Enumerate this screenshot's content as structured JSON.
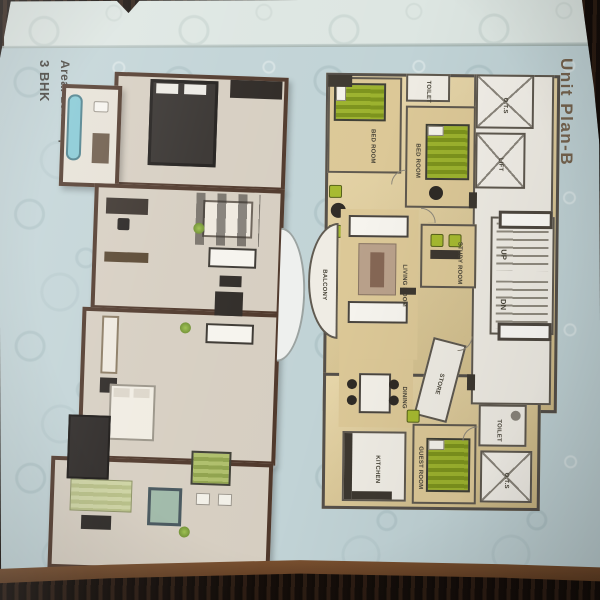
{
  "header": {
    "title": "Unit Plan-B",
    "bhk": "3 BHK",
    "area": "Area: 1946 sq.ft"
  },
  "plan2d": {
    "rooms": {
      "bedroom1": "BED ROOM",
      "toilet_top": "TOILET",
      "bedroom2": "BED ROOM",
      "ots_top": "O.T.S",
      "lift": "LIFT",
      "stairs_up": "UP",
      "stairs_dn": "DN",
      "study": "STUDY ROOM",
      "balcony": "BALCONY",
      "living": "LIVING ROOM",
      "dining": "DINING",
      "store": "STORE",
      "kitchen": "KITCHEN",
      "guest": "GUEST ROOM",
      "toilet_bottom": "TOILET",
      "ots_bottom": "O.T.S"
    }
  },
  "colors": {
    "page_blue": "#c1d3d6",
    "title_brown": "#76644f",
    "floor_tan": "#d7c28c",
    "furniture_green": "#9cb22e",
    "wood_dark": "#20150f"
  }
}
